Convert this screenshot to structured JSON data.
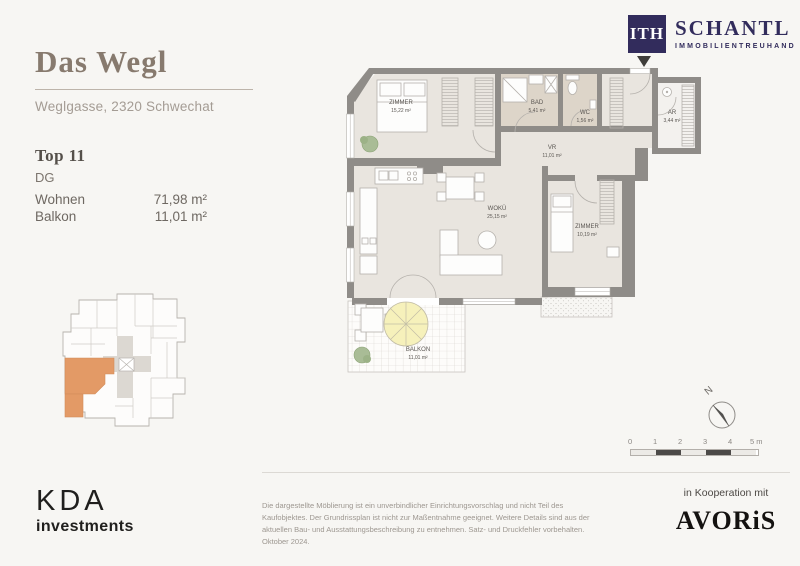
{
  "project": {
    "title": "Das Wegl",
    "address": "Weglgasse, 2320 Schwechat"
  },
  "unit": {
    "name": "Top 11",
    "floor": "DG",
    "areas": [
      {
        "label": "Wohnen",
        "value": "71,98 m²"
      },
      {
        "label": "Balkon",
        "value": "11,01 m²"
      }
    ]
  },
  "floorplan": {
    "rooms": [
      {
        "name": "ZIMMER",
        "area": "15,22 m²"
      },
      {
        "name": "BAD",
        "area": "5,41 m²"
      },
      {
        "name": "WC",
        "area": "1,56 m²"
      },
      {
        "name": "AR",
        "area": "3,44 m²"
      },
      {
        "name": "VR",
        "area": "11,01 m²"
      },
      {
        "name": "WOKÜ",
        "area": "25,15 m²"
      },
      {
        "name": "ZIMMER",
        "area": "10,19 m²"
      },
      {
        "name": "BALKON",
        "area": "11,01 m²"
      }
    ]
  },
  "compass": {
    "label": "N"
  },
  "scalebar": {
    "ticks": [
      "0",
      "1",
      "2",
      "3",
      "4",
      "5 m"
    ]
  },
  "branding": {
    "ith": {
      "monogram": "ITH",
      "name": "SCHANTL",
      "subtitle": "IMMOBILIENTREUHAND"
    },
    "kda": {
      "name": "KDA",
      "subtitle": "investments"
    },
    "avoris": {
      "label": "in Kooperation mit",
      "name": "AVORiS"
    }
  },
  "disclaimer": "Die dargestellte Möblierung ist ein unverbindlicher Einrichtungsvorschlag und nicht Teil des Kaufobjektes. Der Grundrissplan ist nicht zur Maßentnahme geeignet. Weitere Details sind aus der aktuellen Bau- und Ausstattungsbeschreibung zu entnehmen. Satz- und Druckfehler vorbehalten. Oktober 2024.",
  "colors": {
    "highlight_orange": "#e39a66",
    "brand_navy": "#322c5c",
    "wall_gray": "#8f8c88",
    "room_beige": "#e9e5df",
    "bath_beige": "#ddd5c9"
  }
}
